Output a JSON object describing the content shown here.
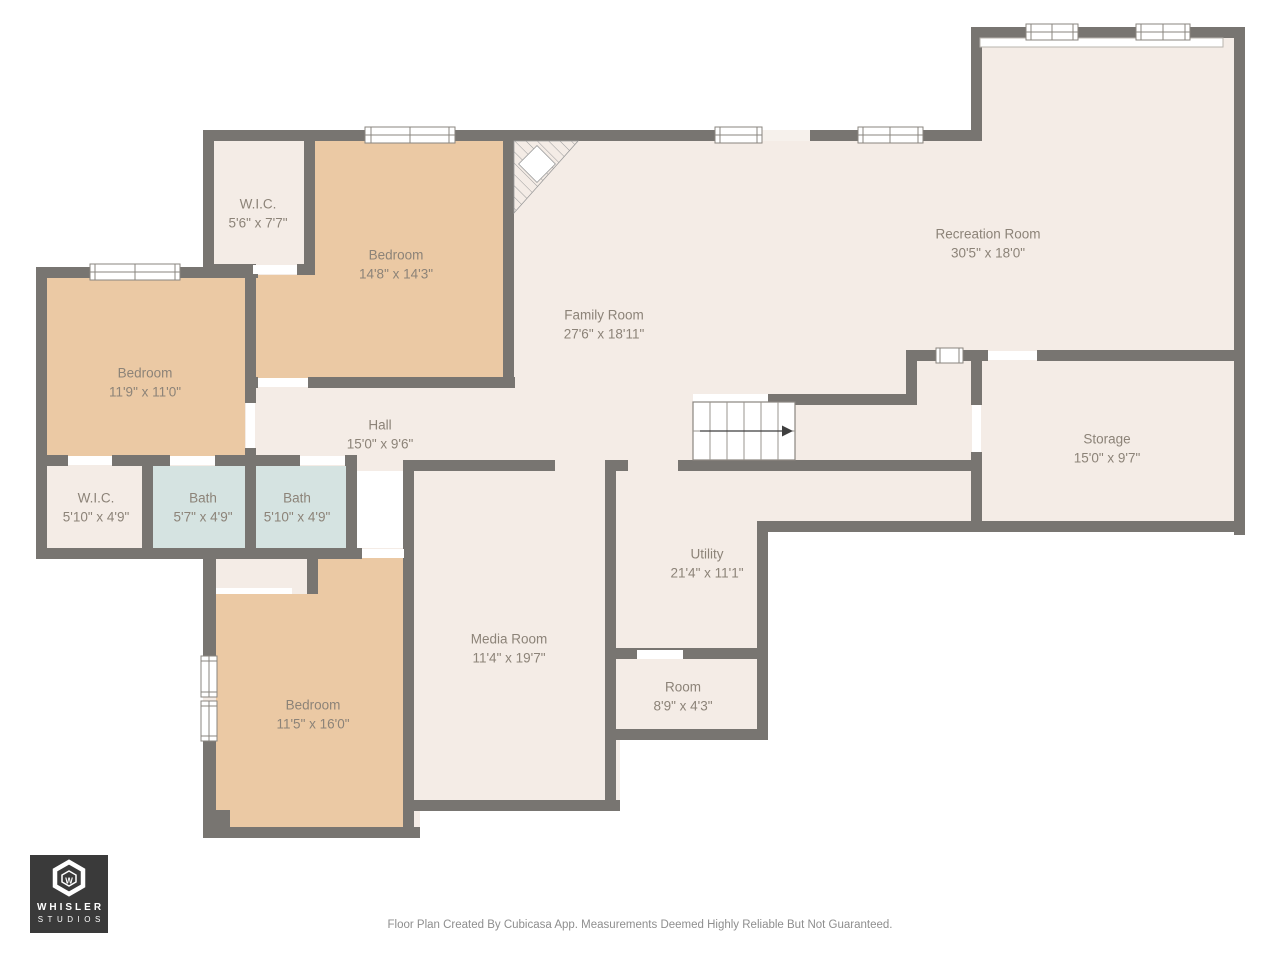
{
  "rooms": [
    {
      "id": "wic-upper",
      "name": "W.I.C.",
      "dims": "5'6\" x 7'7\""
    },
    {
      "id": "bedroom-upper",
      "name": "Bedroom",
      "dims": "14'8\" x 14'3\""
    },
    {
      "id": "bedroom-left",
      "name": "Bedroom",
      "dims": "11'9\" x 11'0\""
    },
    {
      "id": "family-room",
      "name": "Family Room",
      "dims": "27'6\" x 18'11\""
    },
    {
      "id": "recreation-room",
      "name": "Recreation Room",
      "dims": "30'5\" x 18'0\""
    },
    {
      "id": "hall",
      "name": "Hall",
      "dims": "15'0\" x 9'6\""
    },
    {
      "id": "storage",
      "name": "Storage",
      "dims": "15'0\" x 9'7\""
    },
    {
      "id": "wic-lower",
      "name": "W.I.C.",
      "dims": "5'10\" x 4'9\""
    },
    {
      "id": "bath-1",
      "name": "Bath",
      "dims": "5'7\" x 4'9\""
    },
    {
      "id": "bath-2",
      "name": "Bath",
      "dims": "5'10\" x 4'9\""
    },
    {
      "id": "utility",
      "name": "Utility",
      "dims": "21'4\" x 11'1\""
    },
    {
      "id": "media-room",
      "name": "Media Room",
      "dims": "11'4\" x 19'7\""
    },
    {
      "id": "room",
      "name": "Room",
      "dims": "8'9\" x 4'3\""
    },
    {
      "id": "bedroom-lower",
      "name": "Bedroom",
      "dims": "11'5\" x 16'0\""
    }
  ],
  "branding": {
    "monogram": "W",
    "studio_line1": "WHISLER",
    "studio_line2": "STUDIOS"
  },
  "footer": {
    "disclaimer": "Floor Plan Created By Cubicasa App. Measurements Deemed Highly Reliable But Not Guaranteed."
  },
  "colors": {
    "wall": "#787571",
    "floor": "#f4ece6",
    "bedroom_floor": "#ebc9a4",
    "bath_floor": "#d5e3e1",
    "logo_bg": "#3a3a3a",
    "label_text": "#8c8378"
  }
}
